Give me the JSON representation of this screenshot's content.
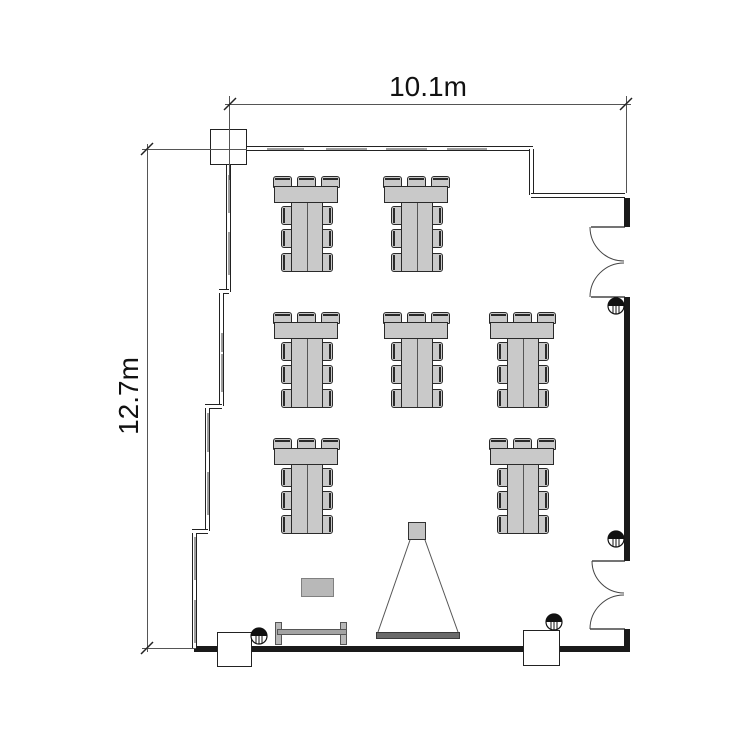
{
  "drawing": {
    "type": "floor-plan",
    "room": {
      "width_label": "10.1m",
      "height_label": "12.7m"
    },
    "features": {
      "double_doors_right_wall": 2,
      "window_bays_top_wall": 4,
      "window_bays_left_wall": 8,
      "columns": 3,
      "pipe_symbols": 4
    }
  },
  "colors": {
    "wall": "#1a1a1a",
    "outline": "#222222",
    "thin_line": "#555555",
    "window_fill": "#9e9e9e",
    "furniture_fill": "#c9c9c9",
    "furniture_edge": "#2a2a2a",
    "screen_fill": "#6a6a6a",
    "side_table_fill": "#b8b8b8"
  },
  "furniture": {
    "table_groups": [
      {
        "x": 273,
        "y": 176
      },
      {
        "x": 383,
        "y": 176
      },
      {
        "x": 273,
        "y": 312
      },
      {
        "x": 383,
        "y": 312
      },
      {
        "x": 489,
        "y": 312
      },
      {
        "x": 273,
        "y": 438
      },
      {
        "x": 489,
        "y": 438
      }
    ],
    "chairs_per_group": 9,
    "has_projector": true,
    "has_screen": true,
    "has_side_table": true,
    "has_bench": true
  }
}
